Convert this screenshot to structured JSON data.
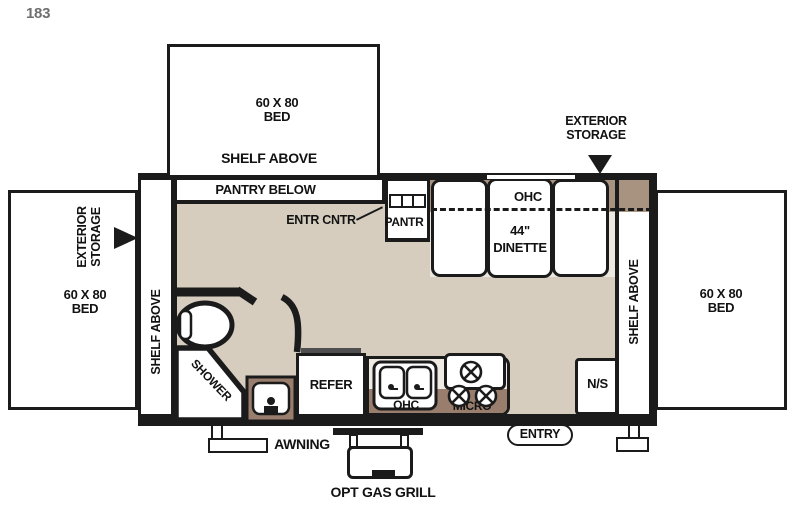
{
  "plan_number": "183",
  "colors": {
    "wall": "#1b1b1b",
    "floor": "#d6cdbf",
    "dinette_platform": "#ece8e0",
    "ohc_strip_brown": "#a89280",
    "counter_brown": "#997e6d",
    "refer_cap_gray": "#4f4f4f",
    "plan_number_gray": "#6f6f6f"
  },
  "front_bed": {
    "size": "60 X 80",
    "name": "BED",
    "shelf": "SHELF ABOVE",
    "pantry_below": "PANTRY BELOW"
  },
  "left_bed": {
    "size": "60 X 80",
    "name": "BED",
    "storage_line1": "EXTERIOR",
    "storage_line2": "STORAGE"
  },
  "right_bed": {
    "size": "60 X 80",
    "name": "BED"
  },
  "right_storage": {
    "line1": "EXTERIOR",
    "line2": "STORAGE"
  },
  "walls": {
    "left_shelf": "SHELF ABOVE",
    "right_shelf": "SHELF ABOVE"
  },
  "entertainment": {
    "label": "ENTR CNTR"
  },
  "pantry_cabinet": {
    "label": "PANTR"
  },
  "dinette": {
    "ohc": "OHC",
    "size": "44\"",
    "name": "DINETTE"
  },
  "bath": {
    "shower": "SHOWER"
  },
  "kitchen": {
    "refer": "REFER",
    "sink_ohc": "OHC",
    "micro": "MICRO"
  },
  "nightstand": "N/S",
  "exterior": {
    "entry": "ENTRY",
    "awning": "AWNING",
    "grill": "OPT GAS GRILL"
  }
}
